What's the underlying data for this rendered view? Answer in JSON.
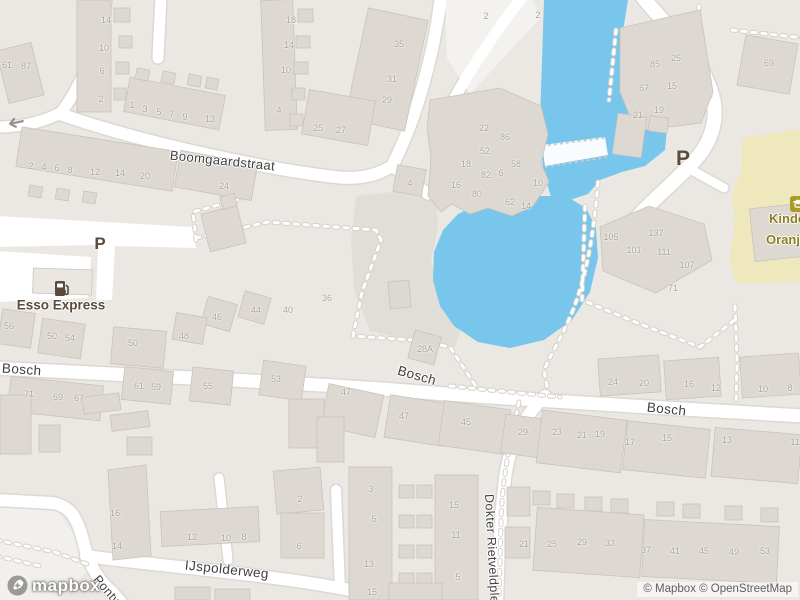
{
  "map": {
    "attribution": "© Mapbox © OpenStreetMap",
    "logo_text": "mapbox",
    "parking_symbol": "P",
    "colors": {
      "land": "#EBE8E4",
      "land_light": "#F2F0EC",
      "block": "#E1DED8",
      "water": "#78C6EC",
      "building": "#DDD8D1",
      "building_stroke": "#C8C3BB",
      "road": "#FFFFFF",
      "casing": "#DCD8D2",
      "school_ground": "#F0E8BD",
      "school_icon": "#A89B26",
      "poi_brown": "#5A4B3C",
      "kind_text": "#8B7E20",
      "street_text": "#3E3E3E",
      "house_number": "#A9A49B",
      "attribution_text": "#5E5E5E",
      "dash": "#FFFFFF",
      "dash_ring": "#D5D1CA"
    },
    "streets": [
      {
        "t": "Boomgaardstraat",
        "x": 170,
        "y": 155,
        "rot": 6,
        "size": 13
      },
      {
        "t": "Bosch",
        "x": 2,
        "y": 368,
        "rot": 4,
        "size": 13.5
      },
      {
        "t": "Bosch",
        "x": 398,
        "y": 370,
        "rot": 16,
        "size": 13.5
      },
      {
        "t": "Bosch",
        "x": 647,
        "y": 407,
        "rot": 6,
        "size": 13.5
      },
      {
        "t": "IJspolderweg",
        "x": 185,
        "y": 565,
        "rot": 6,
        "size": 13.5
      },
      {
        "t": "Pontweg",
        "x": 96,
        "y": 577,
        "rot": 50,
        "size": 12.5
      },
      {
        "t": "Dokter Rietveldplein",
        "x": 489,
        "y": 494,
        "rot": 87,
        "size": 12.5
      }
    ],
    "parking": [
      {
        "x": 100,
        "y": 244,
        "size": 17
      },
      {
        "x": 683,
        "y": 159,
        "size": 21
      }
    ],
    "pois": {
      "esso": {
        "label": "Esso Express",
        "x": 61,
        "y": 305
      },
      "kindcentrum": {
        "line1": "Kindce",
        "line2": "Oranje",
        "x": 769,
        "y": 211
      }
    },
    "house_numbers": [
      {
        "t": "61",
        "x": 7,
        "y": 65
      },
      {
        "t": "87",
        "x": 26,
        "y": 66
      },
      {
        "t": "14",
        "x": 106,
        "y": 20
      },
      {
        "t": "10",
        "x": 104,
        "y": 48
      },
      {
        "t": "6",
        "x": 102,
        "y": 71
      },
      {
        "t": "2",
        "x": 101,
        "y": 99
      },
      {
        "t": "1",
        "x": 132,
        "y": 105
      },
      {
        "t": "3",
        "x": 145,
        "y": 109
      },
      {
        "t": "5",
        "x": 159,
        "y": 112
      },
      {
        "t": "7",
        "x": 172,
        "y": 114
      },
      {
        "t": "9",
        "x": 185,
        "y": 117
      },
      {
        "t": "13",
        "x": 210,
        "y": 119
      },
      {
        "t": "2",
        "x": 31,
        "y": 166
      },
      {
        "t": "4",
        "x": 44,
        "y": 167
      },
      {
        "t": "6",
        "x": 57,
        "y": 168
      },
      {
        "t": "8",
        "x": 70,
        "y": 170
      },
      {
        "t": "12",
        "x": 95,
        "y": 172
      },
      {
        "t": "14",
        "x": 120,
        "y": 173
      },
      {
        "t": "20",
        "x": 145,
        "y": 176
      },
      {
        "t": "24",
        "x": 224,
        "y": 186
      },
      {
        "t": "18",
        "x": 291,
        "y": 20
      },
      {
        "t": "14",
        "x": 289,
        "y": 45
      },
      {
        "t": "10",
        "x": 286,
        "y": 70
      },
      {
        "t": "4",
        "x": 279,
        "y": 110
      },
      {
        "t": "35",
        "x": 399,
        "y": 44
      },
      {
        "t": "31",
        "x": 392,
        "y": 79
      },
      {
        "t": "29",
        "x": 387,
        "y": 100
      },
      {
        "t": "25",
        "x": 318,
        "y": 128
      },
      {
        "t": "27",
        "x": 341,
        "y": 130
      },
      {
        "t": "2",
        "x": 486,
        "y": 16
      },
      {
        "t": "2",
        "x": 538,
        "y": 15
      },
      {
        "t": "22",
        "x": 484,
        "y": 128
      },
      {
        "t": "86",
        "x": 505,
        "y": 137
      },
      {
        "t": "52",
        "x": 485,
        "y": 151
      },
      {
        "t": "18",
        "x": 466,
        "y": 164
      },
      {
        "t": "58",
        "x": 516,
        "y": 164
      },
      {
        "t": "82",
        "x": 486,
        "y": 175
      },
      {
        "t": "6",
        "x": 501,
        "y": 173
      },
      {
        "t": "10",
        "x": 538,
        "y": 183
      },
      {
        "t": "16",
        "x": 456,
        "y": 185
      },
      {
        "t": "80",
        "x": 477,
        "y": 194
      },
      {
        "t": "62",
        "x": 510,
        "y": 202
      },
      {
        "t": "14",
        "x": 526,
        "y": 206
      },
      {
        "t": "4",
        "x": 410,
        "y": 183
      },
      {
        "t": "85",
        "x": 655,
        "y": 64
      },
      {
        "t": "25",
        "x": 676,
        "y": 58
      },
      {
        "t": "67",
        "x": 644,
        "y": 88
      },
      {
        "t": "15",
        "x": 672,
        "y": 86
      },
      {
        "t": "19",
        "x": 659,
        "y": 110
      },
      {
        "t": "21",
        "x": 638,
        "y": 115
      },
      {
        "t": "69",
        "x": 769,
        "y": 63
      },
      {
        "t": "105",
        "x": 611,
        "y": 237
      },
      {
        "t": "137",
        "x": 656,
        "y": 233
      },
      {
        "t": "101",
        "x": 634,
        "y": 250
      },
      {
        "t": "111",
        "x": 664,
        "y": 252
      },
      {
        "t": "107",
        "x": 687,
        "y": 265
      },
      {
        "t": "71",
        "x": 673,
        "y": 288
      },
      {
        "t": "24",
        "x": 613,
        "y": 382
      },
      {
        "t": "20",
        "x": 644,
        "y": 383
      },
      {
        "t": "16",
        "x": 689,
        "y": 384
      },
      {
        "t": "12",
        "x": 716,
        "y": 388
      },
      {
        "t": "10",
        "x": 763,
        "y": 389
      },
      {
        "t": "8",
        "x": 790,
        "y": 388
      },
      {
        "t": "56",
        "x": 9,
        "y": 326
      },
      {
        "t": "50",
        "x": 52,
        "y": 336
      },
      {
        "t": "54",
        "x": 70,
        "y": 338
      },
      {
        "t": "50",
        "x": 133,
        "y": 343
      },
      {
        "t": "48",
        "x": 184,
        "y": 336
      },
      {
        "t": "46",
        "x": 217,
        "y": 317
      },
      {
        "t": "44",
        "x": 256,
        "y": 310
      },
      {
        "t": "71",
        "x": 29,
        "y": 394
      },
      {
        "t": "69",
        "x": 58,
        "y": 397
      },
      {
        "t": "67",
        "x": 79,
        "y": 398
      },
      {
        "t": "61",
        "x": 139,
        "y": 386
      },
      {
        "t": "59",
        "x": 156,
        "y": 387
      },
      {
        "t": "55",
        "x": 208,
        "y": 386
      },
      {
        "t": "53",
        "x": 276,
        "y": 379
      },
      {
        "t": "40",
        "x": 288,
        "y": 310
      },
      {
        "t": "36",
        "x": 327,
        "y": 298
      },
      {
        "t": "28A",
        "x": 425,
        "y": 349
      },
      {
        "t": "47",
        "x": 346,
        "y": 392
      },
      {
        "t": "47",
        "x": 404,
        "y": 416
      },
      {
        "t": "45",
        "x": 466,
        "y": 422
      },
      {
        "t": "29",
        "x": 523,
        "y": 432
      },
      {
        "t": "2",
        "x": 300,
        "y": 499
      },
      {
        "t": "6",
        "x": 299,
        "y": 546
      },
      {
        "t": "3",
        "x": 371,
        "y": 489
      },
      {
        "t": "5",
        "x": 374,
        "y": 519
      },
      {
        "t": "13",
        "x": 369,
        "y": 564
      },
      {
        "t": "15",
        "x": 372,
        "y": 592
      },
      {
        "t": "15",
        "x": 454,
        "y": 505
      },
      {
        "t": "11",
        "x": 456,
        "y": 535
      },
      {
        "t": "5",
        "x": 458,
        "y": 577
      },
      {
        "t": "21",
        "x": 524,
        "y": 544
      },
      {
        "t": "16",
        "x": 115,
        "y": 513
      },
      {
        "t": "14",
        "x": 117,
        "y": 546
      },
      {
        "t": "12",
        "x": 192,
        "y": 537
      },
      {
        "t": "10",
        "x": 226,
        "y": 538
      },
      {
        "t": "8",
        "x": 244,
        "y": 537
      },
      {
        "t": "23",
        "x": 557,
        "y": 432
      },
      {
        "t": "21",
        "x": 582,
        "y": 435
      },
      {
        "t": "19",
        "x": 600,
        "y": 434
      },
      {
        "t": "17",
        "x": 630,
        "y": 442
      },
      {
        "t": "15",
        "x": 667,
        "y": 438
      },
      {
        "t": "13",
        "x": 727,
        "y": 440
      },
      {
        "t": "11",
        "x": 795,
        "y": 442
      },
      {
        "t": "25",
        "x": 552,
        "y": 544
      },
      {
        "t": "29",
        "x": 582,
        "y": 542
      },
      {
        "t": "33",
        "x": 610,
        "y": 543
      },
      {
        "t": "37",
        "x": 646,
        "y": 550
      },
      {
        "t": "41",
        "x": 675,
        "y": 551
      },
      {
        "t": "45",
        "x": 704,
        "y": 551
      },
      {
        "t": "49",
        "x": 734,
        "y": 552
      },
      {
        "t": "53",
        "x": 765,
        "y": 551
      }
    ]
  }
}
